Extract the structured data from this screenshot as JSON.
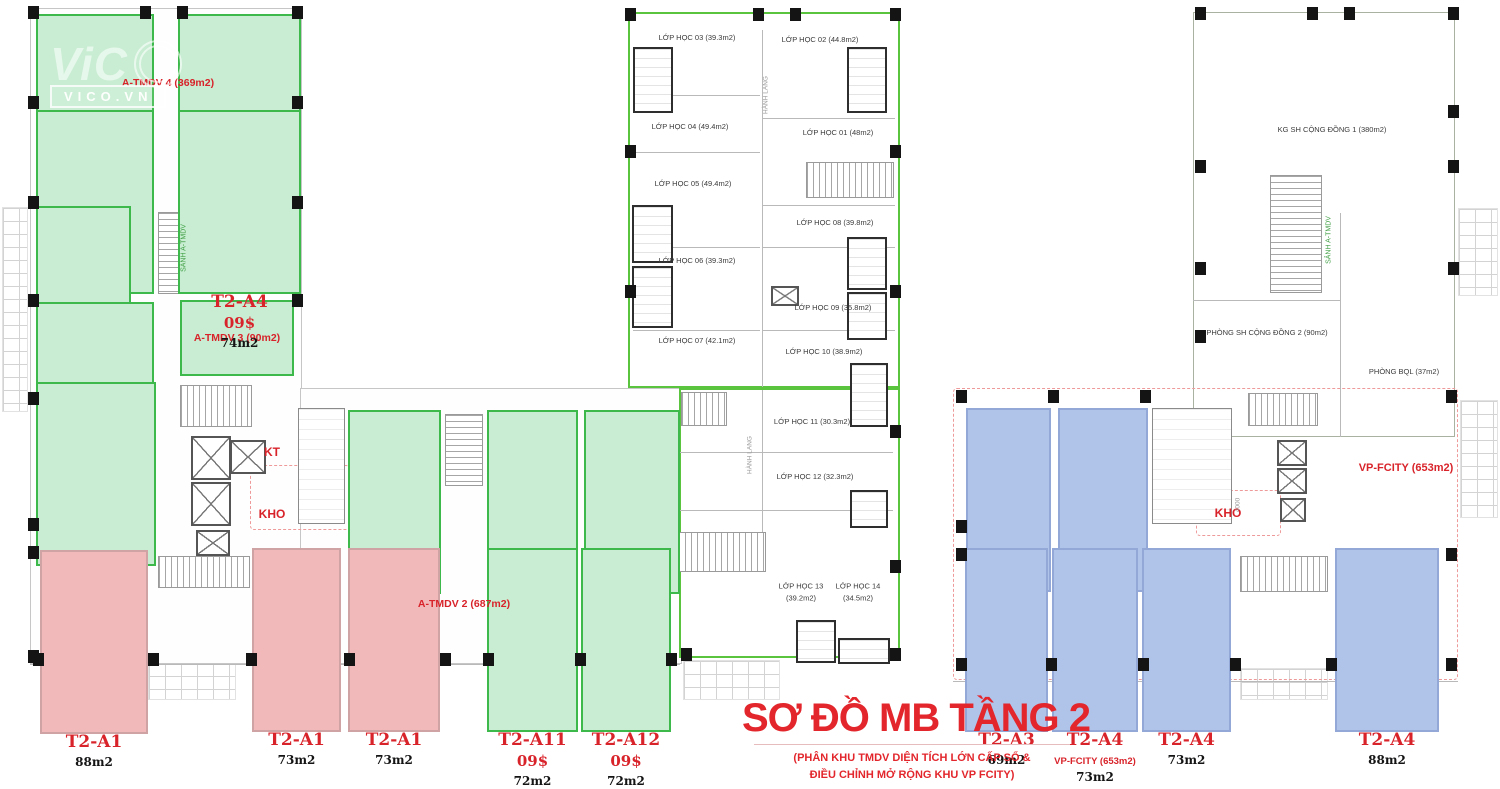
{
  "title": {
    "main": "SƠ ĐỒ MB TẦNG 2",
    "sub1": "(PHÂN KHU TMDV DIỆN TÍCH LỚN CẤP SỔ &",
    "sub2": "ĐIỀU CHỈNH MỞ RỘNG KHU VP FCITY)"
  },
  "watermark": {
    "big": "ViC",
    "small": "VICO.VN"
  },
  "colors": {
    "unit_green_fill": "#c8edd2",
    "unit_pink_fill": "#f1b9ba",
    "unit_blue_fill": "#b0c4ea",
    "outline_green": "#3cb94a",
    "label_red": "#d8232a",
    "title_red": "#e2262c"
  },
  "plan": {
    "units": [
      {
        "cls": "green",
        "x": 36,
        "y": 14,
        "w": 118,
        "h": 88,
        "lines": [
          [
            "name",
            "T2-A1"
          ],
          [
            "price",
            "09$ x1,1"
          ],
          [
            "area",
            "74m2"
          ]
        ]
      },
      {
        "cls": "green",
        "x": 178,
        "y": 14,
        "w": 123,
        "h": 88,
        "lines": [
          [
            "name",
            "T2-A2"
          ],
          [
            "price",
            "09$ x1,1"
          ],
          [
            "area",
            "74m2"
          ]
        ]
      },
      {
        "cls": "green",
        "x": 36,
        "y": 110,
        "w": 118,
        "h": 92,
        "lines": [
          [
            "name",
            "T2-A3"
          ],
          [
            "price",
            "09$"
          ],
          [
            "area",
            "74m2"
          ]
        ]
      },
      {
        "cls": "green",
        "x": 178,
        "y": 110,
        "w": 123,
        "h": 92,
        "lines": [
          [
            "name",
            "T2-A4"
          ],
          [
            "price",
            "09$"
          ],
          [
            "area",
            "74m2"
          ]
        ]
      },
      {
        "cls": "green",
        "x": 36,
        "y": 206,
        "w": 95,
        "h": 90,
        "lines": [
          [
            "name",
            "T2-A5"
          ],
          [
            "price",
            "09$"
          ],
          [
            "area",
            "60m2"
          ]
        ]
      },
      {
        "cls": "green",
        "x": 36,
        "y": 302,
        "w": 118,
        "h": 96,
        "lines": [
          [
            "name",
            "T2-A6"
          ],
          [
            "price",
            "09$"
          ],
          [
            "area",
            "74m2"
          ]
        ]
      },
      {
        "cls": "green",
        "x": 36,
        "y": 382,
        "w": 120,
        "h": 142,
        "lines": [
          [
            "name",
            "T2-A7"
          ],
          [
            "price",
            "09$"
          ],
          [
            "area",
            "90m2"
          ],
          [
            "extra",
            "A-TMDV 1 (264m2)"
          ]
        ]
      },
      {
        "cls": "green",
        "x": 348,
        "y": 410,
        "w": 93,
        "h": 116,
        "lines": [
          [
            "name",
            "T2-A8"
          ],
          [
            "price",
            "09$"
          ],
          [
            "area",
            "74m2"
          ]
        ]
      },
      {
        "cls": "green",
        "x": 487,
        "y": 410,
        "w": 91,
        "h": 116,
        "lines": [
          [
            "name",
            "T2-A9"
          ],
          [
            "price",
            "09$"
          ],
          [
            "area",
            "74m2"
          ]
        ]
      },
      {
        "cls": "green",
        "x": 584,
        "y": 410,
        "w": 96,
        "h": 116,
        "lines": [
          [
            "name",
            "T2-A10"
          ],
          [
            "price",
            "09$"
          ],
          [
            "area",
            "74m2"
          ]
        ]
      },
      {
        "cls": "green",
        "x": 487,
        "y": 548,
        "w": 91,
        "h": 114,
        "lines": [
          [
            "name",
            "T2-A11"
          ],
          [
            "price",
            "09$"
          ],
          [
            "area",
            "72m2"
          ]
        ]
      },
      {
        "cls": "green",
        "x": 581,
        "y": 548,
        "w": 90,
        "h": 114,
        "lines": [
          [
            "name",
            "T2-A12"
          ],
          [
            "price",
            "09$"
          ],
          [
            "area",
            "72m2"
          ]
        ]
      },
      {
        "cls": "pink",
        "x": 40,
        "y": 550,
        "w": 108,
        "h": 112,
        "lines": [
          [
            "name",
            "T2-A1"
          ],
          [
            "area",
            "88m2"
          ]
        ]
      },
      {
        "cls": "pink",
        "x": 252,
        "y": 548,
        "w": 89,
        "h": 114,
        "lines": [
          [
            "name",
            "T2-A1"
          ],
          [
            "area",
            "73m2"
          ]
        ]
      },
      {
        "cls": "pink",
        "x": 348,
        "y": 548,
        "w": 92,
        "h": 114,
        "lines": [
          [
            "name",
            "T2-A1"
          ],
          [
            "area",
            "73m2"
          ]
        ]
      },
      {
        "cls": "blue",
        "x": 966,
        "y": 408,
        "w": 85,
        "h": 116,
        "lines": [
          [
            "name",
            "T2-A1"
          ],
          [
            "area",
            "71m2"
          ]
        ]
      },
      {
        "cls": "blue",
        "x": 1058,
        "y": 408,
        "w": 90,
        "h": 116,
        "lines": [
          [
            "name",
            "T2-A2"
          ],
          [
            "area",
            "74m2"
          ]
        ]
      },
      {
        "cls": "blue",
        "x": 965,
        "y": 548,
        "w": 83,
        "h": 115,
        "lines": [
          [
            "name",
            "T2-A3"
          ],
          [
            "area",
            "69m2"
          ]
        ]
      },
      {
        "cls": "blue",
        "x": 1052,
        "y": 548,
        "w": 86,
        "h": 115,
        "lines": [
          [
            "name",
            "T2-A4"
          ],
          [
            "extra",
            "VP-FCITY (653m2)"
          ],
          [
            "area",
            "73m2"
          ]
        ]
      },
      {
        "cls": "blue",
        "x": 1142,
        "y": 548,
        "w": 89,
        "h": 115,
        "lines": [
          [
            "name",
            "T2-A4"
          ],
          [
            "area",
            "73m2"
          ]
        ]
      },
      {
        "cls": "blue",
        "x": 1335,
        "y": 548,
        "w": 104,
        "h": 115,
        "lines": [
          [
            "name",
            "T2-A4"
          ],
          [
            "area",
            "88m2"
          ]
        ]
      }
    ],
    "areas": [
      {
        "t": "A-TMDV 3 (90m2)",
        "x": 180,
        "y": 300,
        "w": 114,
        "h": 76
      }
    ],
    "rooms": [
      {
        "lines": [
          "LỚP HỌC 03 (39.3m2)"
        ],
        "x": 697,
        "y": 38
      },
      {
        "lines": [
          "LỚP HỌC 02 (44.8m2)"
        ],
        "x": 820,
        "y": 40
      },
      {
        "lines": [
          "LỚP HỌC 04 (49.4m2)"
        ],
        "x": 690,
        "y": 127
      },
      {
        "lines": [
          "LỚP HỌC 01 (48m2)"
        ],
        "x": 838,
        "y": 133
      },
      {
        "lines": [
          "LỚP HỌC 05 (49.4m2)"
        ],
        "x": 693,
        "y": 184
      },
      {
        "lines": [
          "LỚP HỌC 08 (39.8m2)"
        ],
        "x": 835,
        "y": 223
      },
      {
        "lines": [
          "LỚP HỌC 06 (39.3m2)"
        ],
        "x": 697,
        "y": 261
      },
      {
        "lines": [
          "LỚP HỌC 09 (35.8m2)"
        ],
        "x": 833,
        "y": 308
      },
      {
        "lines": [
          "LỚP HỌC 07 (42.1m2)"
        ],
        "x": 697,
        "y": 341
      },
      {
        "lines": [
          "LỚP HỌC 10 (38.9m2)"
        ],
        "x": 824,
        "y": 352
      },
      {
        "lines": [
          "LỚP HỌC 11 (30.3m2)"
        ],
        "x": 812,
        "y": 422
      },
      {
        "lines": [
          "LỚP HỌC 12 (32.3m2)"
        ],
        "x": 815,
        "y": 477
      },
      {
        "lines": [
          "LỚP HỌC 13",
          "(39.2m2)"
        ],
        "x": 801,
        "y": 592
      },
      {
        "lines": [
          "LỚP HỌC 14",
          "(34.5m2)"
        ],
        "x": 858,
        "y": 592
      },
      {
        "lines": [
          "KG SH CỘNG ĐỒNG 1 (380m2)"
        ],
        "x": 1332,
        "y": 130
      },
      {
        "lines": [
          "PHÒNG SH CỘNG ĐỒNG 2 (90m2)"
        ],
        "x": 1267,
        "y": 333
      },
      {
        "lines": [
          "PHÒNG BQL (37m2)"
        ],
        "x": 1404,
        "y": 372
      }
    ],
    "labels": [
      {
        "t": "A-TMDV 4 (369m2)",
        "cls": "red",
        "x": 168,
        "y": 83,
        "size": 10.5
      },
      {
        "t": "A-TMDV 2 (687m2)",
        "cls": "red",
        "x": 464,
        "y": 604,
        "size": 10.5
      },
      {
        "t": "KT",
        "cls": "red",
        "x": 272,
        "y": 452,
        "size": 12
      },
      {
        "t": "KHO",
        "cls": "red",
        "x": 272,
        "y": 514,
        "size": 12
      },
      {
        "t": "KHO",
        "cls": "red",
        "x": 1228,
        "y": 513,
        "size": 12
      },
      {
        "t": "VP-FCITY (653m2)",
        "cls": "red",
        "x": 1406,
        "y": 468,
        "size": 11
      },
      {
        "t": "SẢNH A-TMDV",
        "cls": "greenv",
        "x": 184,
        "y": 248,
        "size": 7
      },
      {
        "t": "SẢNH A-TMDV",
        "cls": "greenv",
        "x": 1329,
        "y": 240,
        "size": 7
      },
      {
        "t": "HÀNH LANG",
        "cls": "grayv",
        "x": 766,
        "y": 95,
        "size": 6.5
      },
      {
        "t": "HÀNH LANG",
        "cls": "grayv",
        "x": 750,
        "y": 455,
        "size": 6.5
      },
      {
        "t": "4000",
        "cls": "grayv",
        "x": 1238,
        "y": 505,
        "size": 6.5
      }
    ]
  }
}
